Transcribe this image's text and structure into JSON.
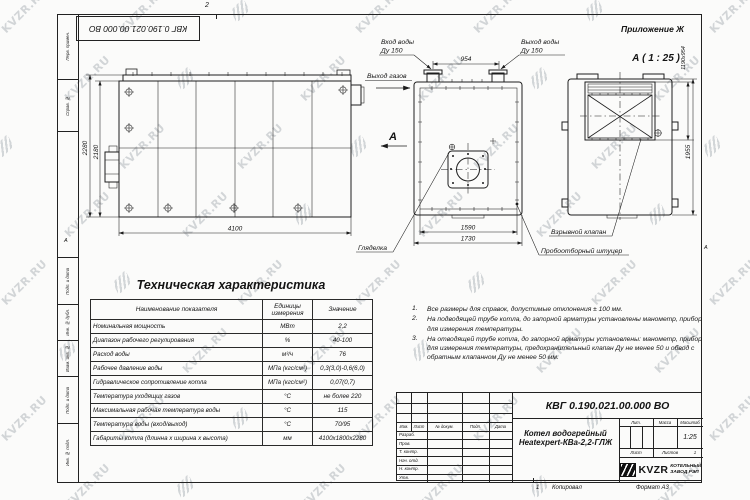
{
  "watermark": {
    "text": "KVZR.RU"
  },
  "sheet": {
    "appendix": "Приложение Ж",
    "zone_top": "2",
    "zone_bottom": "1",
    "fold_mark": "А",
    "copied_label": "Копировал",
    "format_label": "Формат А3",
    "top_doc_number": "КВГ 0.190.021.00.000 ВО",
    "left_col_labels": [
      "Перв. примен.",
      "Справ. №",
      "Подп. и дата",
      "Инв. № дубл.",
      "Взам. инв. №",
      "Подп. и дата",
      "Инв. № подл."
    ]
  },
  "views": {
    "view_a_label": "А ( 1 : 25 )",
    "section_arrow_label": "А",
    "labels": {
      "water_in": "Вход воды",
      "water_in_dn": "Ду 150",
      "water_out": "Выход воды",
      "water_out_dn": "Ду 150",
      "gas_out": "Выход газов",
      "sight_glass": "Гляделка",
      "explosion_valve": "Взрывной клапан",
      "sampling_fitting": "Пробоотборный штуцер"
    },
    "dimensions": {
      "side_height_outer": "2280",
      "side_height_inner": "2180",
      "side_length": "4100",
      "pipe_spacing": "954",
      "front_width_inner": "1590",
      "front_width_outer": "1730",
      "back_height": "1955",
      "back_opening": "1190х954"
    }
  },
  "spec_table": {
    "title": "Техническая характеристика",
    "headers": [
      "Наименование показателя",
      "Единицы измерения",
      "Значение"
    ],
    "rows": [
      [
        "Номинальная мощность",
        "МВт",
        "2,2"
      ],
      [
        "Диапазон рабочего регулирования",
        "%",
        "40-100"
      ],
      [
        "Расход воды",
        "м³/ч",
        "76"
      ],
      [
        "Рабочее давление воды",
        "МПа (кгс/см²)",
        "0,3(3,0)-0,6(6,0)"
      ],
      [
        "Гидравлическое сопротивление котла",
        "МПа (кгс/см²)",
        "0,07(0,7)"
      ],
      [
        "Температура уходящих газов",
        "°С",
        "не более 220"
      ],
      [
        "Максимальная рабочая температура воды",
        "°С",
        "115"
      ],
      [
        "Температура воды (вход/выход)",
        "°С",
        "70/95"
      ],
      [
        "Габариты котла (длинна х ширина х высота)",
        "мм",
        "4100х1800х2280"
      ]
    ]
  },
  "notes": [
    {
      "num": "1.",
      "text": "Все размеры для справок, допустимые отклонения ± 100 мм."
    },
    {
      "num": "2.",
      "text": "На подводящей трубе котла, до запорной арматуры установлены манометр, прибор для измерения температуры."
    },
    {
      "num": "3.",
      "text": "На отводящей трубе котла, до запорной арматуры установлены: манометр, прибор для измерения температуры, предохранительный клапан Ду не менее 50 и обвод с обратным клапанном Ду не менее 50 мм."
    }
  ],
  "title_block": {
    "doc_number": "КВГ 0.190.021.00.000 ВО",
    "product_name_1": "Котел водогрейный",
    "product_name_2": "Heatexpert-КВа-2,2-ГЛЖ",
    "header_lit": "Лит.",
    "header_mass": "Масса",
    "header_scale": "Масштаб",
    "scale": "1:25",
    "sheet_label": "Лист",
    "sheets_label": "Листов",
    "sheets_value": "1",
    "company_logo": "KVZR",
    "company_name_1": "КОТЕЛЬНЫЙ",
    "company_name_2": "ЗАВОД РЭП",
    "rev_headers": [
      "Изм.",
      "Лист",
      "№ докум.",
      "Подп.",
      "Дата"
    ],
    "sign_rows": [
      "Разраб.",
      "Пров.",
      "Т. контр.",
      "Нач. отд.",
      "Н. контр.",
      "Утв."
    ]
  }
}
